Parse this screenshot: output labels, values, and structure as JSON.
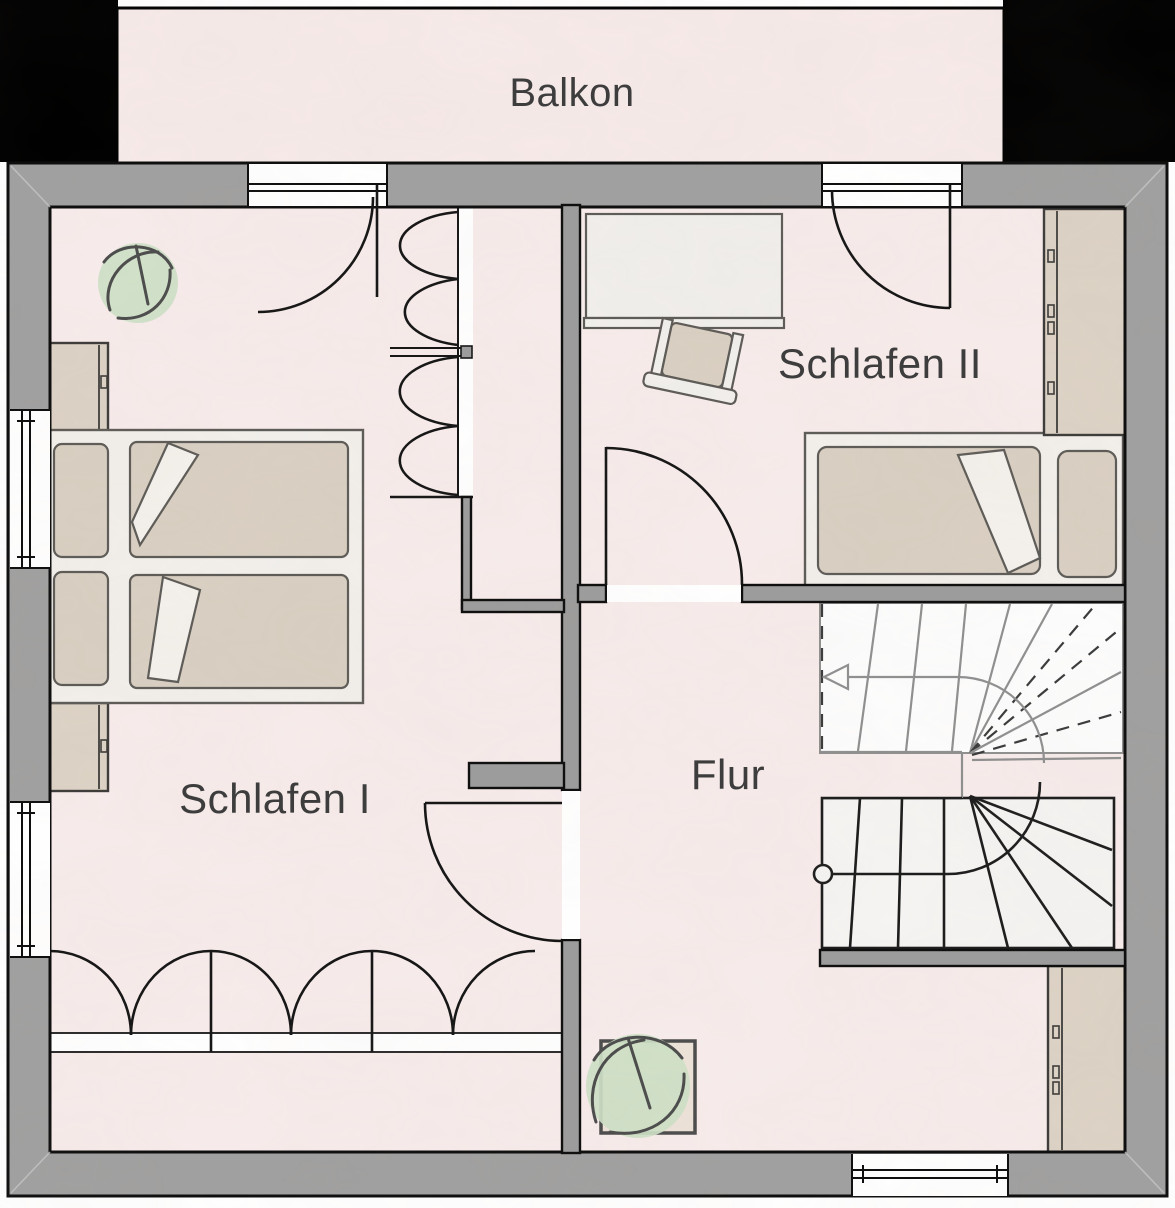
{
  "floor_plan": {
    "balcony": {
      "label": "Balkon"
    },
    "rooms": [
      {
        "id": "schlafen-1",
        "label": "Schlafen I"
      },
      {
        "id": "schlafen-2",
        "label": "Schlafen II"
      },
      {
        "id": "flur",
        "label": "Flur"
      }
    ],
    "stairs": {
      "direction_arrow": "up-to-left"
    }
  },
  "colors": {
    "floor": "#f7eceb",
    "balcony_floor": "#f6eae9",
    "wall": "#a0a0a0",
    "wall_inner": "#9c9c9c",
    "wall_outline": "#0c0c0c",
    "furniture_fill": "#f2efeb",
    "furniture_outline": "#5d5b57",
    "bedding": "#d9cfc2",
    "wardrobe": "#dcd2c5",
    "plant": "#cde0c5",
    "stair_upper": "#8f8f8f",
    "stair_lower": "#1c1c1c",
    "text": "#3d3d3d"
  }
}
